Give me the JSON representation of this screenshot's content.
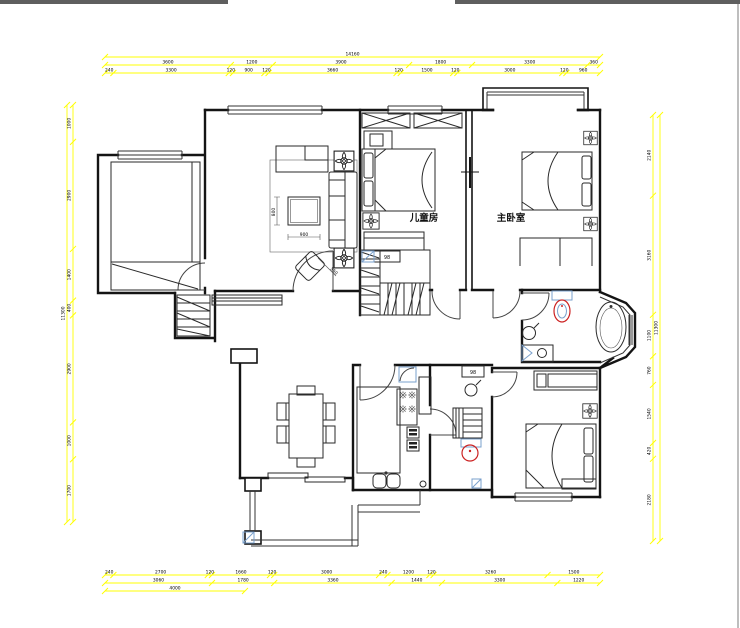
{
  "window": {
    "top_bars": [
      {
        "x": 0,
        "width": 228
      },
      {
        "x": 455,
        "width": 285
      }
    ],
    "bar_color": "#5f5f5f",
    "right_edge_color": "#a9a9a9"
  },
  "plan": {
    "labels": {
      "children_room": "儿童房",
      "master_bedroom": "主卧室"
    },
    "tiny_labels": {
      "closet_label": "98",
      "bath_label": "98"
    },
    "furniture_dims": {
      "coffee_table_depth": "800",
      "coffee_table_width": "900",
      "armchair_width": "550"
    },
    "colors": {
      "wall": "#141414",
      "fixture_red": "#cc2222",
      "fixture_blue": "#7aa0cc"
    }
  },
  "dimensions": {
    "line_color": "#ffff00",
    "text_color": "#000000",
    "top": {
      "x1": 105,
      "x2": 600,
      "rows": [
        {
          "y": 57,
          "values": [
            14160
          ]
        },
        {
          "y": 65,
          "values": [
            3600,
            1200,
            3900,
            1800,
            3300,
            360
          ]
        },
        {
          "y": 73,
          "values": [
            240,
            3300,
            120,
            900,
            120,
            3660,
            120,
            1500,
            120,
            3000,
            120,
            960
          ]
        }
      ]
    },
    "bottom": {
      "x1": 105,
      "x2": 600,
      "rows": [
        {
          "y": 575,
          "values": [
            240,
            2700,
            120,
            1660,
            120,
            3000,
            240,
            1200,
            120,
            3260,
            1500
          ]
        },
        {
          "y": 583,
          "values": [
            3060,
            1780,
            3360,
            1440,
            3300,
            1220
          ]
        },
        {
          "y": 591,
          "x2": 245,
          "values": [
            4000
          ]
        }
      ]
    },
    "left": {
      "y1": 105,
      "y2": 522,
      "cols": [
        {
          "x": 67,
          "values": [
            11300
          ]
        },
        {
          "x": 73,
          "values": [
            1000,
            2900,
            1400,
            400,
            2900,
            1000,
            1700
          ]
        }
      ]
    },
    "right": {
      "y1": 115,
      "y2": 541,
      "cols": [
        {
          "x": 660,
          "values": [
            11300
          ]
        },
        {
          "x": 653,
          "values": [
            2140,
            3160,
            1100,
            760,
            1540,
            420,
            2180
          ]
        }
      ]
    }
  }
}
